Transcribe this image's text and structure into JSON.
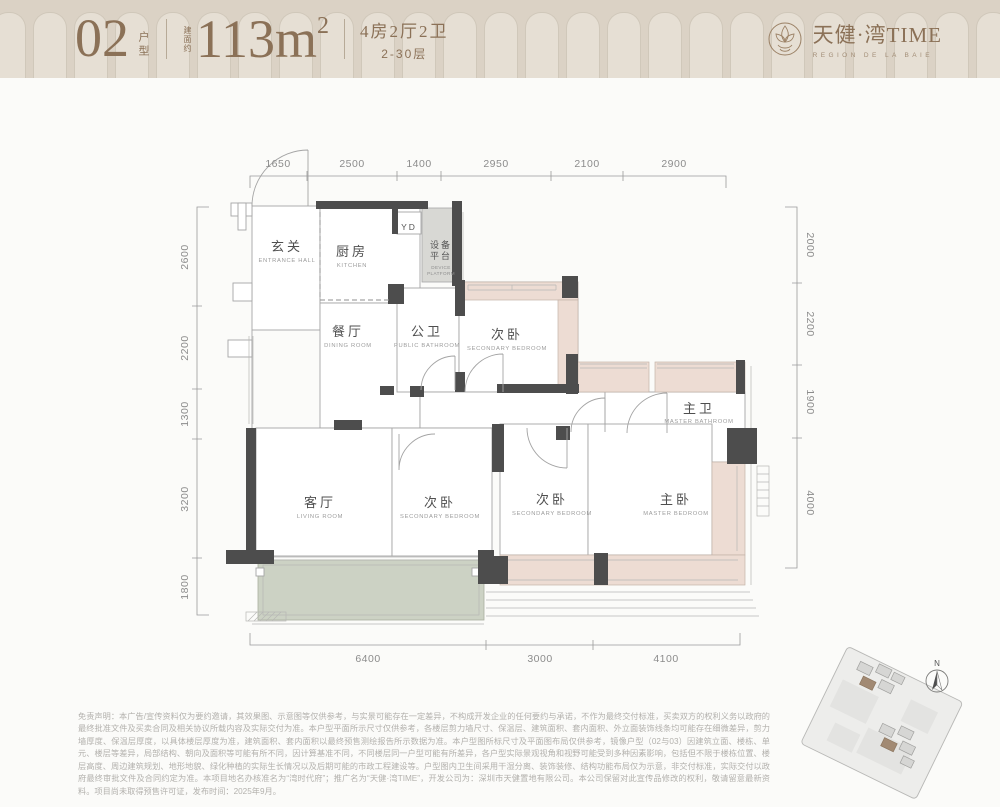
{
  "header": {
    "unit_number": "02",
    "unit_suffix": "户型",
    "area_prefix": "建面约",
    "area_value": "113m",
    "area_exponent": "2",
    "rooms_line": "4房2厅2卫",
    "floors_line": "2-30层",
    "brand_cn": "天健·湾TIME",
    "brand_en": "REGION DE LA BAIE"
  },
  "floor_plan": {
    "rooms": [
      {
        "cn": "玄关",
        "en": "ENTRANCE HALL"
      },
      {
        "cn": "厨房",
        "en": "KITCHEN"
      },
      {
        "cn": "餐厅",
        "en": "DINING ROOM"
      },
      {
        "cn": "公卫",
        "en": "PUBLIC BATHROOM"
      },
      {
        "cn": "次卧",
        "en": "SECONDARY BEDROOM"
      },
      {
        "cn": "主卫",
        "en": "MASTER BATHROOM"
      },
      {
        "cn": "客厅",
        "en": "LIVING ROOM"
      },
      {
        "cn": "次卧",
        "en": "SECONDARY BEDROOM"
      },
      {
        "cn": "次卧",
        "en": "SECONDARY BEDROOM"
      },
      {
        "cn": "主卧",
        "en": "MASTER BEDROOM"
      }
    ],
    "labels": {
      "yd": "YD",
      "device_line1": "设备",
      "device_line2": "平台",
      "device_en1": "DEVICE",
      "device_en2": "PLATFORM"
    },
    "dimensions": {
      "top": [
        "1650",
        "2500",
        "1400",
        "2950",
        "2100",
        "2900"
      ],
      "bottom": [
        "6400",
        "3000",
        "4100"
      ],
      "left": [
        "2600",
        "2200",
        "1300",
        "3200",
        "1800"
      ],
      "right": [
        "2000",
        "2200",
        "1900",
        "4000"
      ]
    }
  },
  "site_map": {
    "north_label": "N"
  },
  "disclaimer": "免责声明：本广告/宣传资料仅为要约邀请，其效果图、示意图等仅供参考，与实景可能存在一定差异，不构成开发企业的任何要约与承诺，不作为最终交付标准，买卖双方的权利义务以政府的最终批准文件及买卖合同及相关协议所载内容及实际交付为准。本户型平面所示尺寸仅供参考，各楼层剪力墙尺寸、保温层、建筑面积、套内面积、外立面装饰线条均可能存在细微差异，剪力墙厚度、保温层厚度，以具体楼层厚度为准，建筑面积、套内面积以最终预售测绘报告所示数据为准。本户型图所标尺寸及平面图布局仅供参考，镜像户型（02与03）因建筑立面、楼栋、单元、楼层等差异，局部结构、朝向及面积等可能有所不同，因计算基准不同，不同楼层同一户型可能有所差异，各户型实际景观视角和视野可能受到多种因素影响，包括但不限于楼栋位置、楼层高度、周边建筑规划、地形地貌、绿化种植的实际生长情况以及后期可能的市政工程建设等。户型图内卫生间采用干湿分离、装饰装修、结构功能布局仅为示意，非交付标准，实际交付以政府最终审批文件及合同约定为准。本项目地名办核准名为“湾时代府”；推广名为“天健·湾TIME”，开发公司为：深圳市天健置地有限公司。本公司保留对此宣传品修改的权利，敬请留意最新资料。项目尚未取得预售许可证，发布时间：2025年9月。",
  "colors": {
    "header_bg": "#dbd2c5",
    "accent_brown": "#8b7157",
    "wall_dark": "#4d4d4d",
    "bay_pink": "#eddcd3",
    "balcony_green": "#ccd2c4"
  }
}
